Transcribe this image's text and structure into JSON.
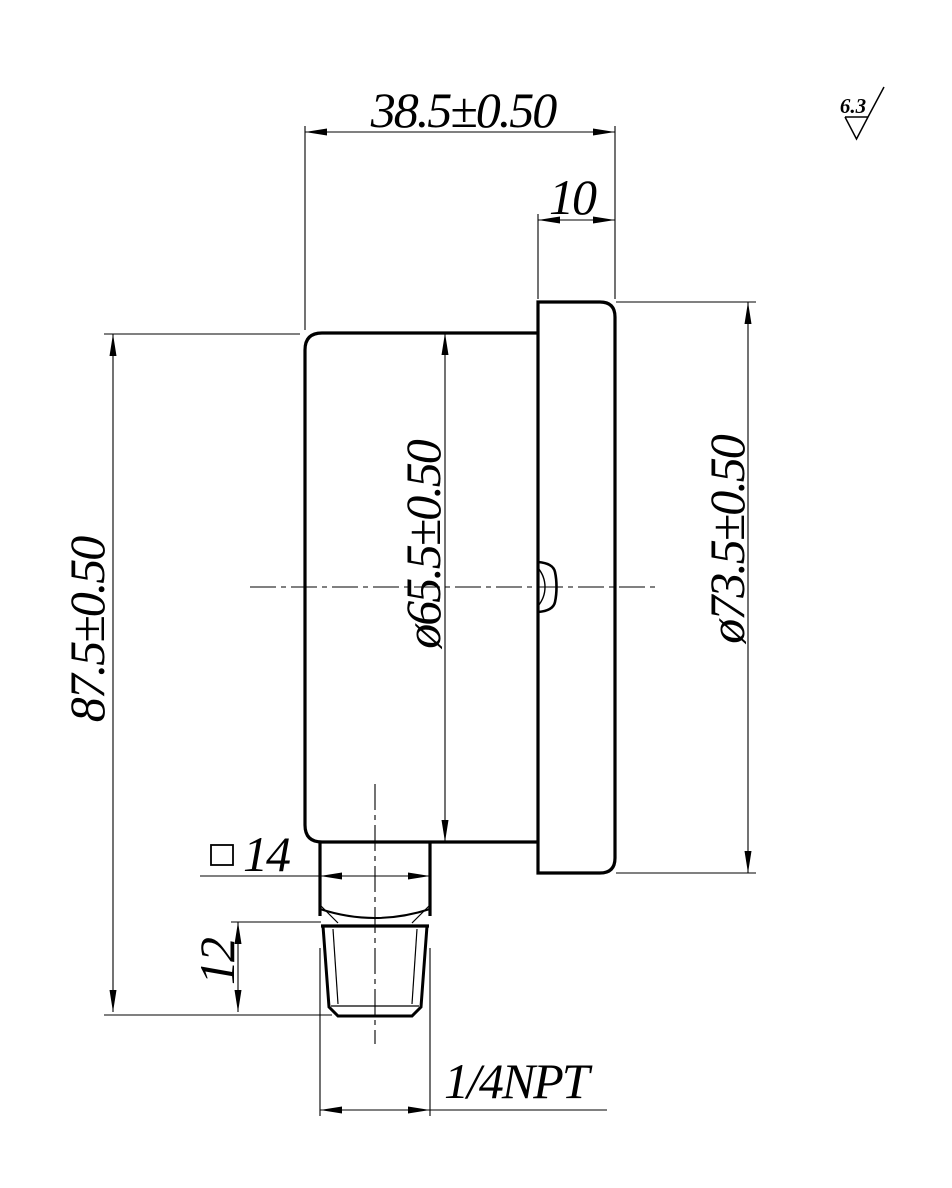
{
  "page": {
    "background": "#ffffff",
    "line_color": "#000000"
  },
  "drawing": {
    "view": "pressure-gauge-side-view",
    "dimensions": {
      "overall_depth": "38.5±0.50",
      "bezel_depth": "10",
      "overall_height": "87.5±0.50",
      "case_diameter": "ø65.5±0.50",
      "bezel_diameter": "ø73.5±0.50",
      "wrench_square": "14",
      "thread_length": "12",
      "thread_spec": "1/4NPT"
    },
    "surface_finish": {
      "value": "6.3"
    },
    "symbols": {
      "square": "□",
      "surface_finish": "checkmark-triangle"
    }
  }
}
